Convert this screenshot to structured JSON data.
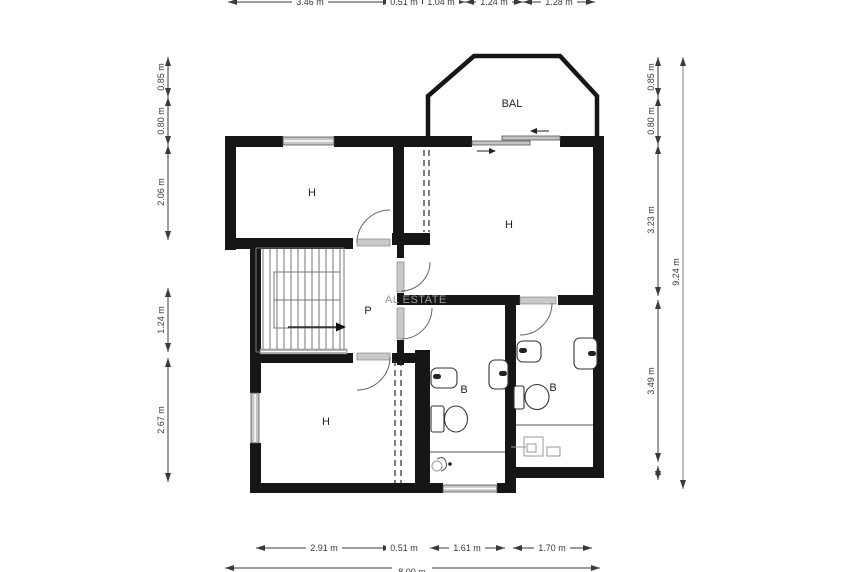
{
  "watermark": "AL ESTATE",
  "rooms": {
    "bal": {
      "label": "BAL"
    },
    "h_top_left": {
      "label": "H"
    },
    "h_top_right": {
      "label": "H"
    },
    "h_bottom_left": {
      "label": "H"
    },
    "hallway": {
      "label": "P"
    },
    "bath_middle": {
      "label": "B"
    },
    "bath_right": {
      "label": "B"
    }
  },
  "dimensions": {
    "top": [
      {
        "label": "3.46 m"
      },
      {
        "label": "0.51 m"
      },
      {
        "label": "1.04 m"
      },
      {
        "label": "1.24 m"
      },
      {
        "label": "1.28 m"
      }
    ],
    "bottom": [
      {
        "label": "2.91 m"
      },
      {
        "label": "0.51 m"
      },
      {
        "label": "1.61 m"
      },
      {
        "label": "1.70 m"
      }
    ],
    "bottom_total": {
      "label": "8.00 m"
    },
    "left": [
      {
        "label": "0.85 m"
      },
      {
        "label": "0.80 m"
      },
      {
        "label": "2.06 m"
      },
      {
        "label": "1.24 m"
      },
      {
        "label": "2.67 m"
      }
    ],
    "right": [
      {
        "label": "0.85 m"
      },
      {
        "label": "0.80 m"
      },
      {
        "label": "3.23 m"
      },
      {
        "label": "3.49 m"
      }
    ],
    "right_total": {
      "label": "9.24 m"
    }
  }
}
